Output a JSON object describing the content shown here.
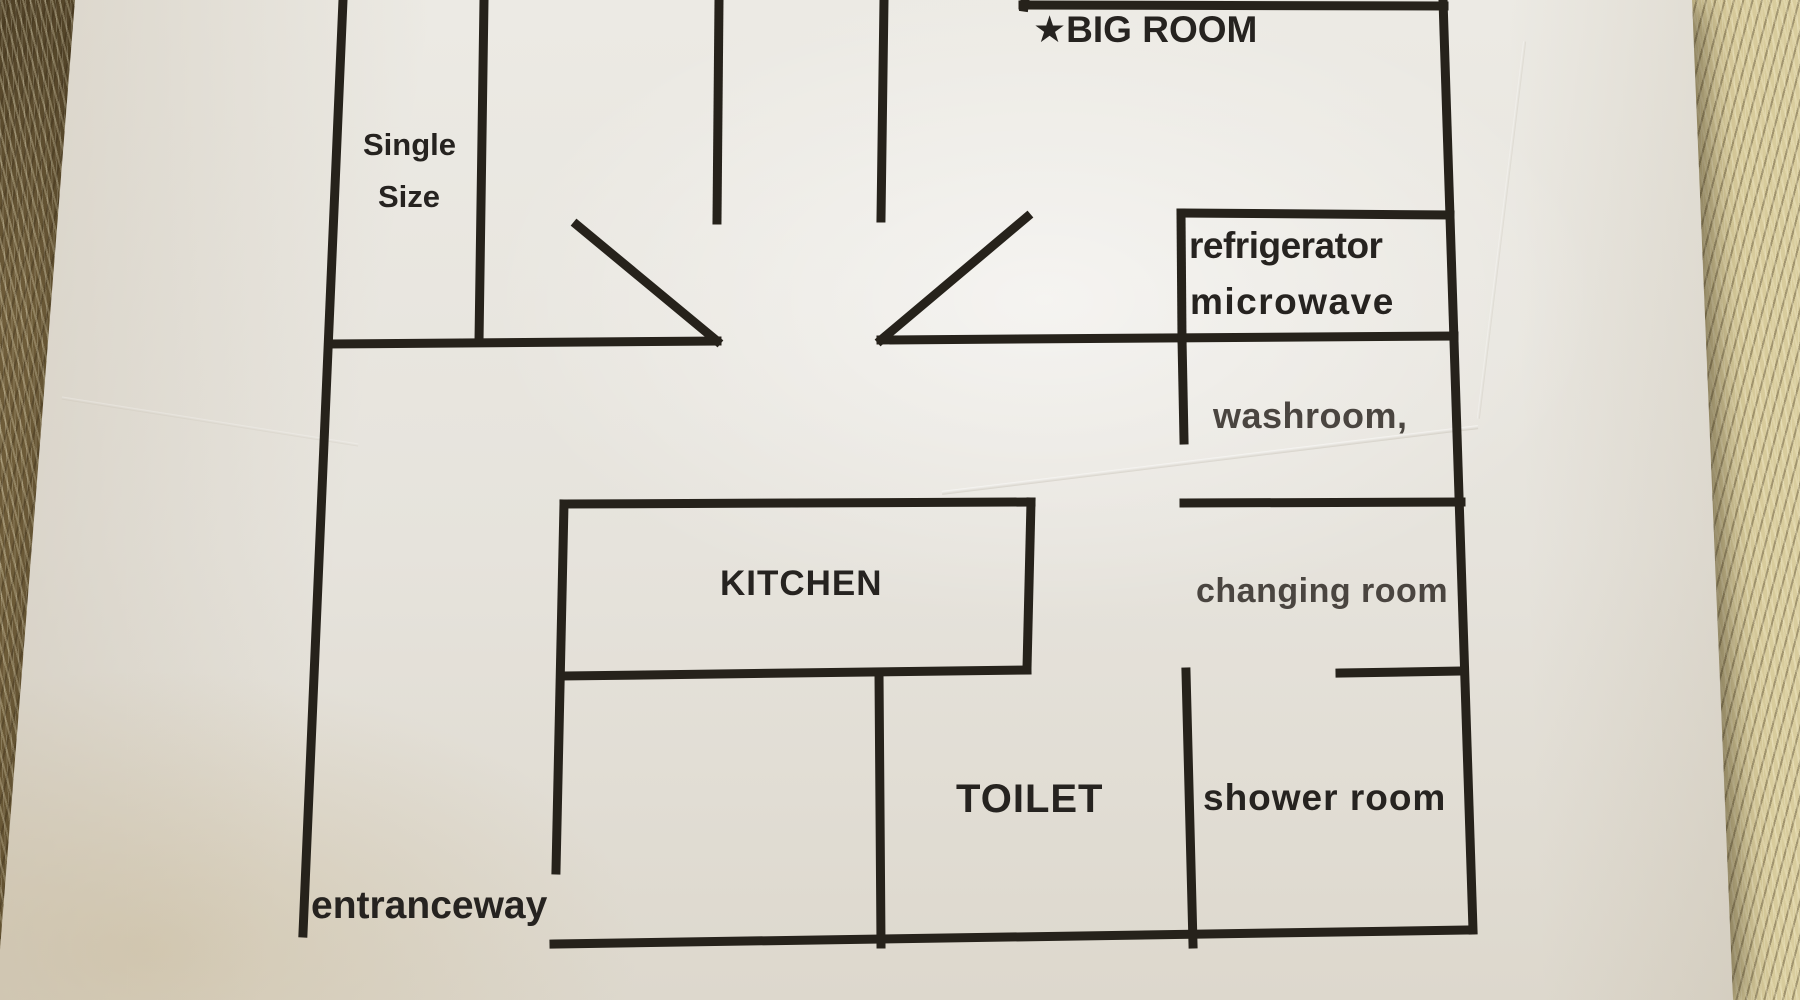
{
  "scene": {
    "description": "Printed apartment floor plan on a white sheet of paper, photographed lying on a shaggy tan carpet"
  },
  "colors": {
    "wall": "#26221b",
    "text_dark": "#262320",
    "text_gray": "#4a4540",
    "paper": "#e6e3dc",
    "carpet_base": "#97825a"
  },
  "floor_plan": {
    "wall_stroke_width": 9,
    "labels": {
      "big_room": "★BIG ROOM",
      "single_size_line1": "Single",
      "single_size_line2": "Size",
      "refrigerator": "refrigerator",
      "microwave": "microwave",
      "washroom": "washroom,",
      "changing_room": "changing room",
      "kitchen": "KITCHEN",
      "toilet": "TOILET",
      "shower_room": "shower room",
      "entranceway": "entranceway"
    },
    "walls": [
      {
        "name": "left-outer-wall",
        "x1": 343,
        "y1": 0,
        "x2": 303,
        "y2": 933
      },
      {
        "name": "single-room-right-wall",
        "x1": 484,
        "y1": 0,
        "x2": 479,
        "y2": 341
      },
      {
        "name": "passage-left-wall",
        "x1": 719,
        "y1": 0,
        "x2": 717,
        "y2": 220
      },
      {
        "name": "passage-right-wall",
        "x1": 884,
        "y1": 0,
        "x2": 881,
        "y2": 218
      },
      {
        "name": "big-room-top-box-bottom-wall",
        "x1": 1023,
        "y1": 5,
        "x2": 1444,
        "y2": 6
      },
      {
        "name": "big-room-top-box-left-stub",
        "x1": 1025,
        "y1": 0,
        "x2": 1024,
        "y2": 7
      },
      {
        "name": "right-outer-wall",
        "x1": 1443,
        "y1": 0,
        "x2": 1473,
        "y2": 930
      },
      {
        "name": "hall-top-wall-left",
        "x1": 329,
        "y1": 344,
        "x2": 717,
        "y2": 341
      },
      {
        "name": "door-swing-left",
        "x1": 577,
        "y1": 225,
        "x2": 717,
        "y2": 341
      },
      {
        "name": "hall-top-wall-right",
        "x1": 881,
        "y1": 340,
        "x2": 1454,
        "y2": 336
      },
      {
        "name": "door-swing-right",
        "x1": 881,
        "y1": 340,
        "x2": 1027,
        "y2": 217
      },
      {
        "name": "refrigerator-box-left-wall",
        "x1": 1181,
        "y1": 213,
        "x2": 1182,
        "y2": 339
      },
      {
        "name": "refrigerator-box-top-wall",
        "x1": 1182,
        "y1": 213,
        "x2": 1450,
        "y2": 215
      },
      {
        "name": "washroom-door-wall",
        "x1": 1182,
        "y1": 339,
        "x2": 1184,
        "y2": 440
      },
      {
        "name": "washroom-bottom-wall",
        "x1": 1184,
        "y1": 503,
        "x2": 1461,
        "y2": 502
      },
      {
        "name": "kitchen-top-wall",
        "x1": 564,
        "y1": 504,
        "x2": 1031,
        "y2": 502
      },
      {
        "name": "kitchen-right-wall",
        "x1": 1031,
        "y1": 502,
        "x2": 1027,
        "y2": 668
      },
      {
        "name": "kitchen-bottom-wall",
        "x1": 564,
        "y1": 676,
        "x2": 1027,
        "y2": 670
      },
      {
        "name": "kitchen-left-wall",
        "x1": 564,
        "y1": 504,
        "x2": 556,
        "y2": 870
      },
      {
        "name": "toilet-left-wall",
        "x1": 879,
        "y1": 674,
        "x2": 881,
        "y2": 944
      },
      {
        "name": "shower-room-left-wall",
        "x1": 1186,
        "y1": 672,
        "x2": 1193,
        "y2": 944
      },
      {
        "name": "shower-room-top-stub",
        "x1": 1340,
        "y1": 673,
        "x2": 1464,
        "y2": 671
      },
      {
        "name": "bottom-outer-wall",
        "x1": 554,
        "y1": 944,
        "x2": 1470,
        "y2": 930
      }
    ]
  }
}
